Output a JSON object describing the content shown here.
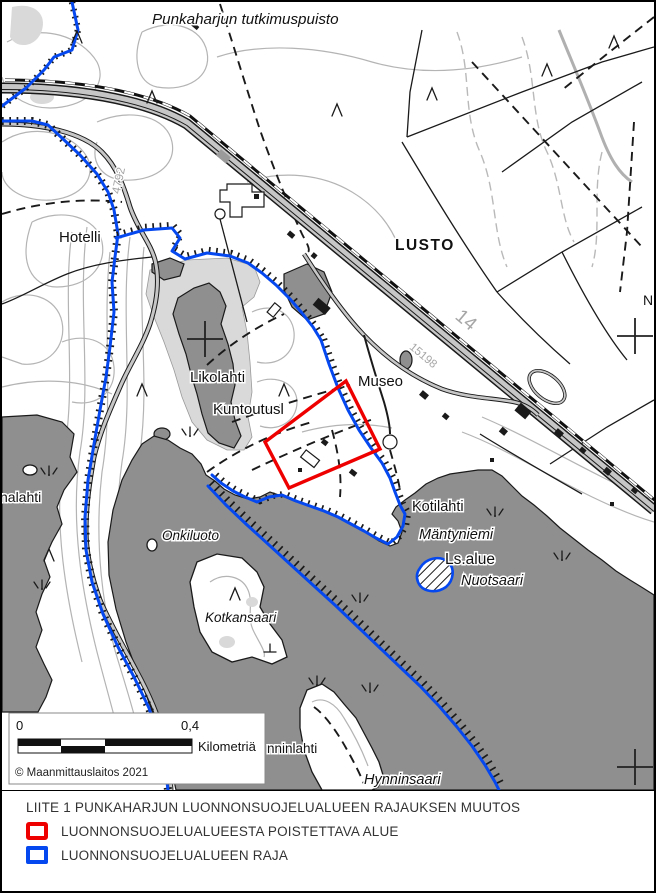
{
  "map": {
    "labels": {
      "title": "Punkaharjun tutkimuspuisto",
      "hotelli": "Hotelli",
      "lusto": "LUSTO",
      "likolahti": "Likolahti",
      "museo": "Museo",
      "kuntoutusl": "Kuntoutusl",
      "kotilahti": "Kotilahti",
      "mantyniemi": "Mäntyniemi",
      "ls_alue": "Ls.alue",
      "nuotsaari": "Nuotsaari",
      "onkiluoto": "Onkiluoto",
      "kotkansaari": "Kotkansaari",
      "nalahti_partial": "nalahti",
      "nninlahti_partial": "nninlahti",
      "hynninsaari": "Hynninsaari",
      "n_partial": "N"
    },
    "road_numbers": {
      "main": "14",
      "r4792": "4792",
      "r15198": "15198"
    },
    "scale_bar": {
      "start": "0",
      "end": "0,4",
      "unit": "Kilometriä"
    },
    "copyright": "© Maanmittauslaitos 2021"
  },
  "legend": {
    "title": "LIITE 1 PUNKAHARJUN LUONNONSUOJELUALUEEN RAJAUKSEN MUUTOS",
    "items": [
      {
        "label": "LUONNONSUOJELUALUEESTA POISTETTAVA ALUE",
        "color": "#ee0000"
      },
      {
        "label": "LUONNONSUOJELUALUEEN RAJA",
        "color": "#0548f0"
      }
    ]
  },
  "colors": {
    "water": "#8f8f8f",
    "marsh": "#d9d9d9",
    "contour": "#b4b4b4",
    "road_fill": "#c6c6c6",
    "boundary_blue": "#0548f0",
    "removal_red": "#ee0000"
  }
}
